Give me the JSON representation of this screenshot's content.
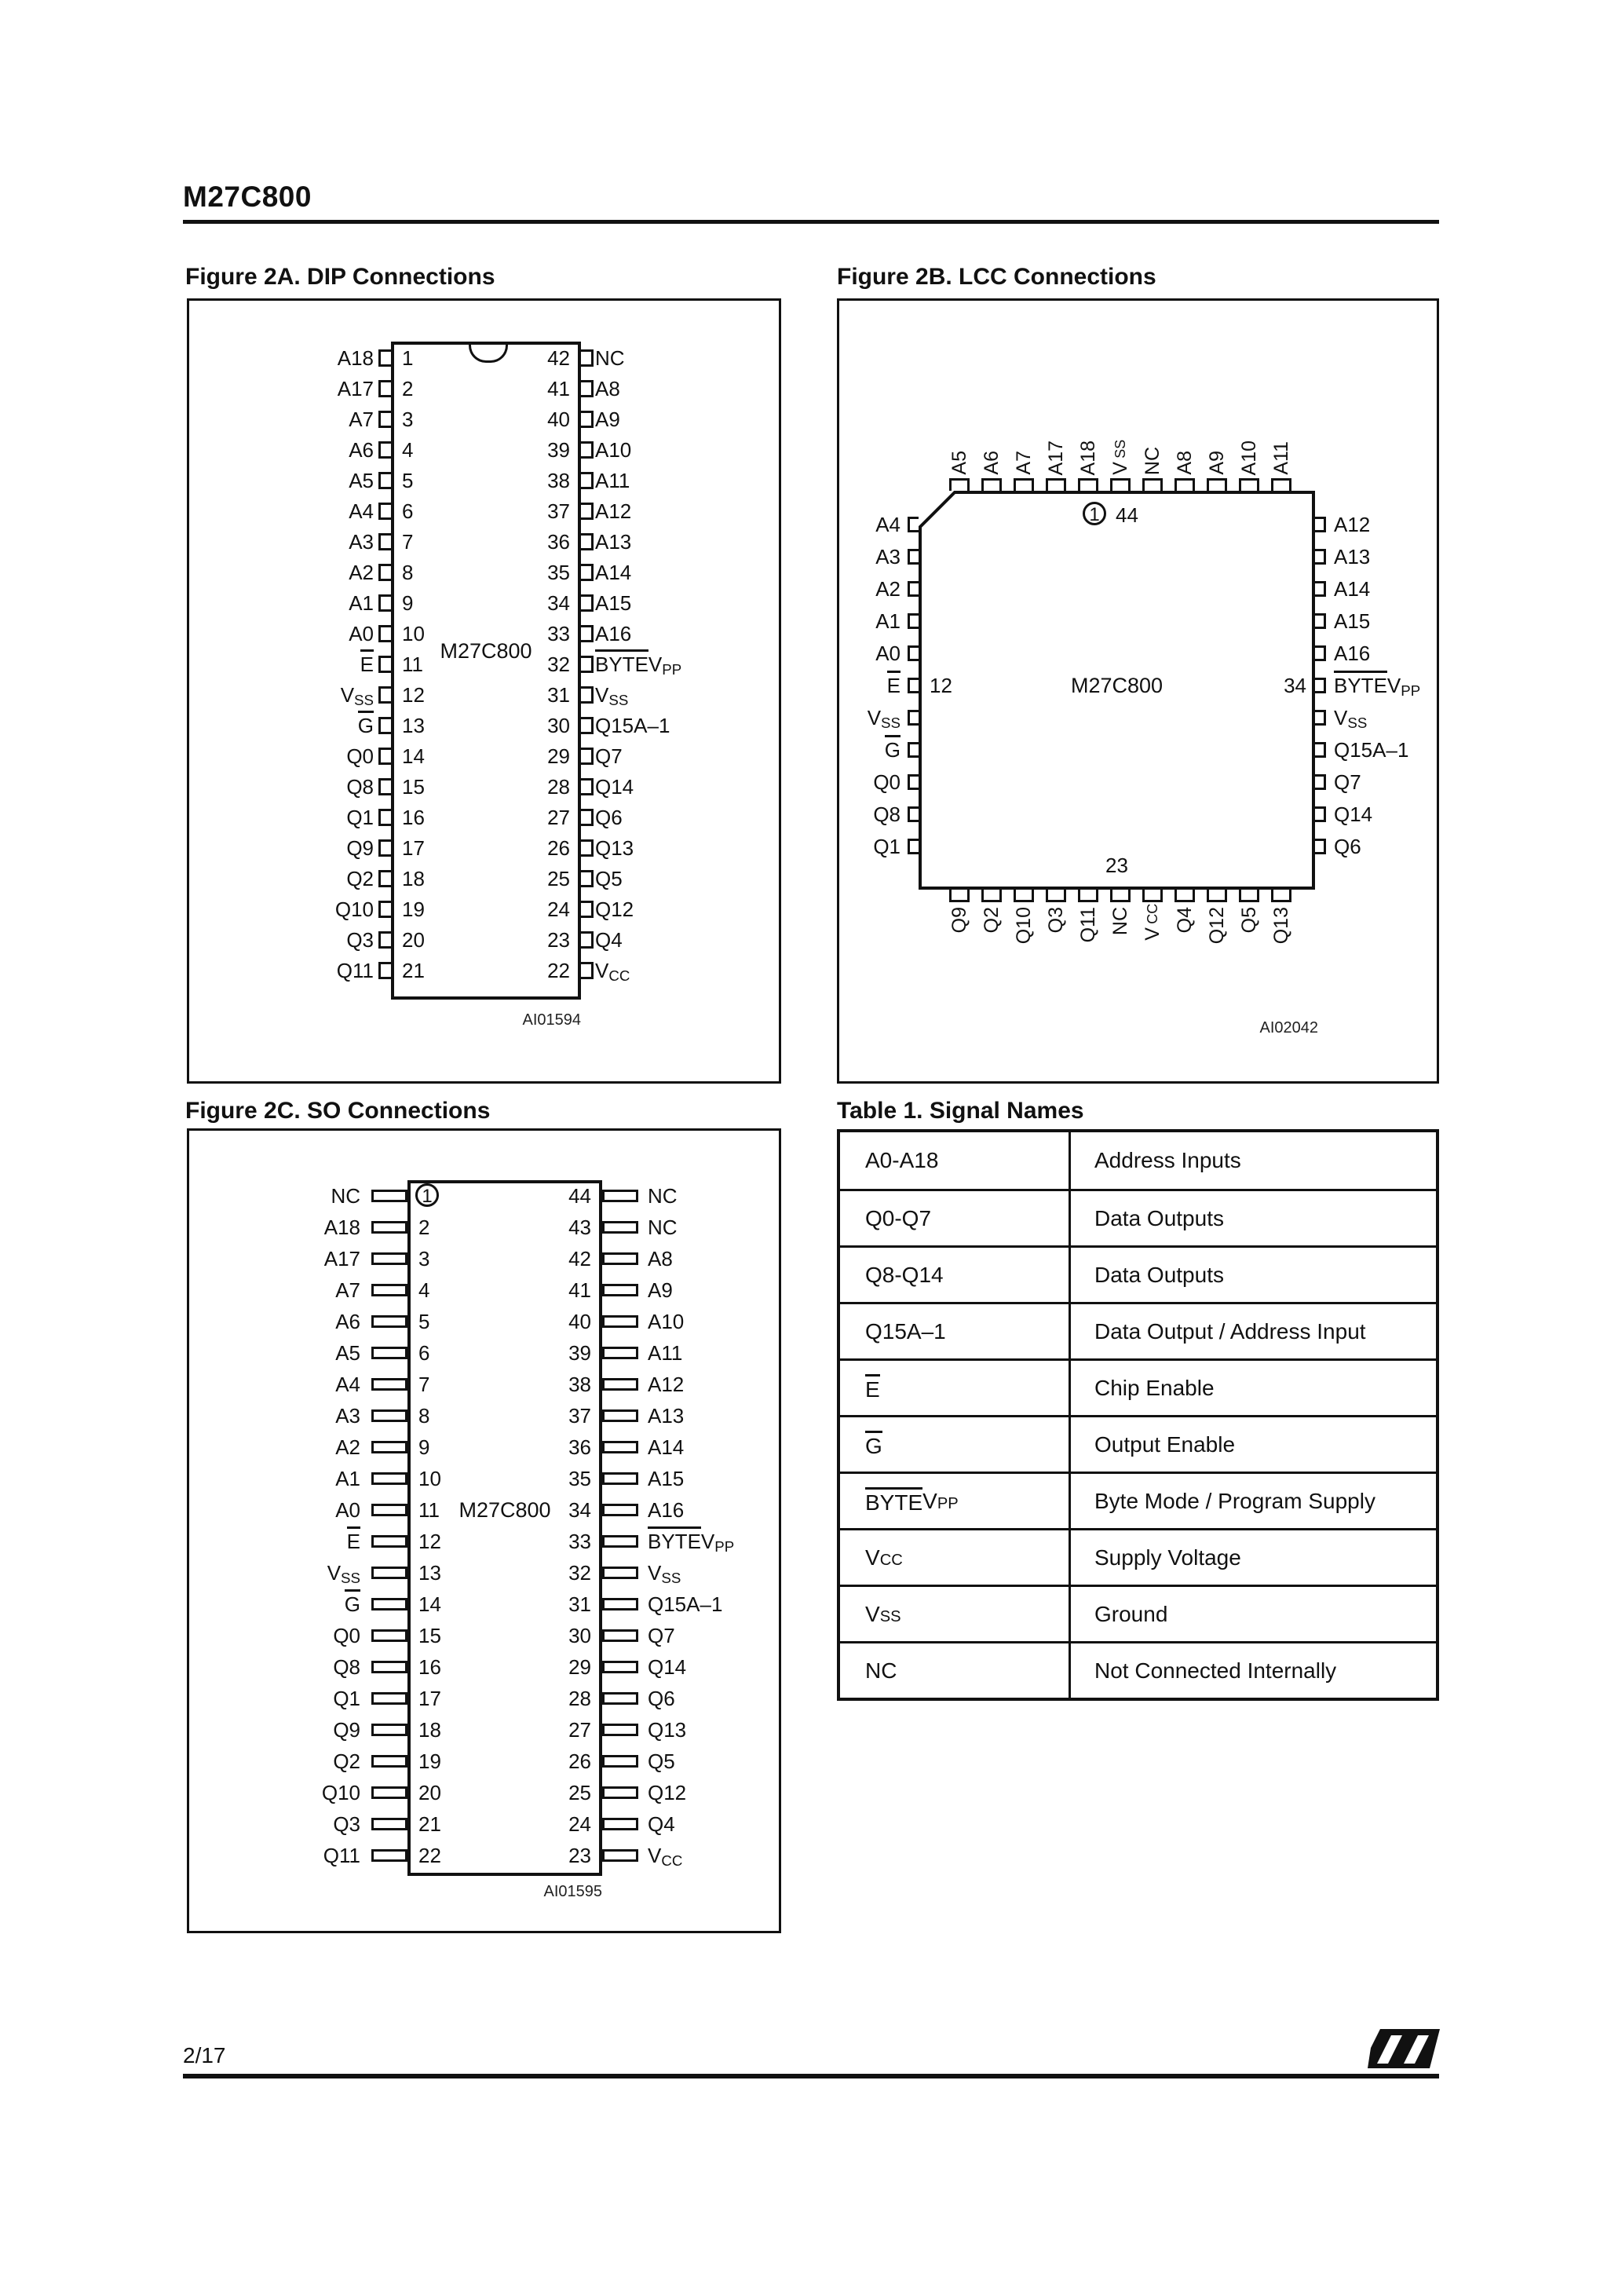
{
  "page": {
    "title": "M27C800",
    "page_number": "2/17",
    "logo_icon": "st-logo"
  },
  "figure_2a": {
    "title": "Figure 2A. DIP Connections",
    "chip_label": "M27C800",
    "tag": "AI01594",
    "left_pins": [
      {
        "label": "A18",
        "num": "1"
      },
      {
        "label": "A17",
        "num": "2"
      },
      {
        "label": "A7",
        "num": "3"
      },
      {
        "label": "A6",
        "num": "4"
      },
      {
        "label": "A5",
        "num": "5"
      },
      {
        "label": "A4",
        "num": "6"
      },
      {
        "label": "A3",
        "num": "7"
      },
      {
        "label": "A2",
        "num": "8"
      },
      {
        "label": "A1",
        "num": "9"
      },
      {
        "label": "A0",
        "num": "10"
      },
      {
        "label": "~E~",
        "num": "11"
      },
      {
        "label": "V_SS_",
        "num": "12"
      },
      {
        "label": "~G~",
        "num": "13"
      },
      {
        "label": "Q0",
        "num": "14"
      },
      {
        "label": "Q8",
        "num": "15"
      },
      {
        "label": "Q1",
        "num": "16"
      },
      {
        "label": "Q9",
        "num": "17"
      },
      {
        "label": "Q2",
        "num": "18"
      },
      {
        "label": "Q10",
        "num": "19"
      },
      {
        "label": "Q3",
        "num": "20"
      },
      {
        "label": "Q11",
        "num": "21"
      }
    ],
    "right_pins": [
      {
        "num": "42",
        "label": "NC"
      },
      {
        "num": "41",
        "label": "A8"
      },
      {
        "num": "40",
        "label": "A9"
      },
      {
        "num": "39",
        "label": "A10"
      },
      {
        "num": "38",
        "label": "A11"
      },
      {
        "num": "37",
        "label": "A12"
      },
      {
        "num": "36",
        "label": "A13"
      },
      {
        "num": "35",
        "label": "A14"
      },
      {
        "num": "34",
        "label": "A15"
      },
      {
        "num": "33",
        "label": "A16"
      },
      {
        "num": "32",
        "label": "~BYTE~V_PP_"
      },
      {
        "num": "31",
        "label": "V_SS_"
      },
      {
        "num": "30",
        "label": "Q15A–1"
      },
      {
        "num": "29",
        "label": "Q7"
      },
      {
        "num": "28",
        "label": "Q14"
      },
      {
        "num": "27",
        "label": "Q6"
      },
      {
        "num": "26",
        "label": "Q13"
      },
      {
        "num": "25",
        "label": "Q5"
      },
      {
        "num": "24",
        "label": "Q12"
      },
      {
        "num": "23",
        "label": "Q4"
      },
      {
        "num": "22",
        "label": "V_CC_"
      }
    ]
  },
  "figure_2b": {
    "title": "Figure 2B. LCC Connections",
    "chip_label": "M27C800",
    "tag": "AI02042",
    "pin1_marker": "1",
    "top_right_num": "44",
    "left_num": "12",
    "right_num": "34",
    "bottom_num": "23",
    "top_pins": [
      "A5",
      "A6",
      "A7",
      "A17",
      "A18",
      "V_SS_",
      "NC",
      "A8",
      "A9",
      "A10",
      "A11"
    ],
    "left_pins": [
      "A4",
      "A3",
      "A2",
      "A1",
      "A0",
      "~E~",
      "V_SS_",
      "~G~",
      "Q0",
      "Q8",
      "Q1"
    ],
    "right_pins": [
      "A12",
      "A13",
      "A14",
      "A15",
      "A16",
      "~BYTE~V_PP_",
      "V_SS_",
      "Q15A–1",
      "Q7",
      "Q14",
      "Q6"
    ],
    "bottom_pins": [
      "Q9",
      "Q2",
      "Q10",
      "Q3",
      "Q11",
      "NC",
      "V_CC_",
      "Q4",
      "Q12",
      "Q5",
      "Q13"
    ]
  },
  "figure_2c": {
    "title": "Figure 2C. SO Connections",
    "chip_label": "M27C800",
    "tag": "AI01595",
    "left_pins": [
      {
        "label": "NC",
        "num": "1",
        "circled": true
      },
      {
        "label": "A18",
        "num": "2"
      },
      {
        "label": "A17",
        "num": "3"
      },
      {
        "label": "A7",
        "num": "4"
      },
      {
        "label": "A6",
        "num": "5"
      },
      {
        "label": "A5",
        "num": "6"
      },
      {
        "label": "A4",
        "num": "7"
      },
      {
        "label": "A3",
        "num": "8"
      },
      {
        "label": "A2",
        "num": "9"
      },
      {
        "label": "A1",
        "num": "10"
      },
      {
        "label": "A0",
        "num": "11"
      },
      {
        "label": "~E~",
        "num": "12"
      },
      {
        "label": "V_SS_",
        "num": "13"
      },
      {
        "label": "~G~",
        "num": "14"
      },
      {
        "label": "Q0",
        "num": "15"
      },
      {
        "label": "Q8",
        "num": "16"
      },
      {
        "label": "Q1",
        "num": "17"
      },
      {
        "label": "Q9",
        "num": "18"
      },
      {
        "label": "Q2",
        "num": "19"
      },
      {
        "label": "Q10",
        "num": "20"
      },
      {
        "label": "Q3",
        "num": "21"
      },
      {
        "label": "Q11",
        "num": "22"
      }
    ],
    "right_pins": [
      {
        "num": "44",
        "label": "NC"
      },
      {
        "num": "43",
        "label": "NC"
      },
      {
        "num": "42",
        "label": "A8"
      },
      {
        "num": "41",
        "label": "A9"
      },
      {
        "num": "40",
        "label": "A10"
      },
      {
        "num": "39",
        "label": "A11"
      },
      {
        "num": "38",
        "label": "A12"
      },
      {
        "num": "37",
        "label": "A13"
      },
      {
        "num": "36",
        "label": "A14"
      },
      {
        "num": "35",
        "label": "A15"
      },
      {
        "num": "34",
        "label": "A16"
      },
      {
        "num": "33",
        "label": "~BYTE~V_PP_"
      },
      {
        "num": "32",
        "label": "V_SS_"
      },
      {
        "num": "31",
        "label": "Q15A–1"
      },
      {
        "num": "30",
        "label": "Q7"
      },
      {
        "num": "29",
        "label": "Q14"
      },
      {
        "num": "28",
        "label": "Q6"
      },
      {
        "num": "27",
        "label": "Q13"
      },
      {
        "num": "26",
        "label": "Q5"
      },
      {
        "num": "25",
        "label": "Q12"
      },
      {
        "num": "24",
        "label": "Q4"
      },
      {
        "num": "23",
        "label": "V_CC_"
      }
    ]
  },
  "table_1": {
    "title": "Table 1. Signal Names",
    "rows": [
      {
        "signal": "A0-A18",
        "description": "Address Inputs"
      },
      {
        "signal": "Q0-Q7",
        "description": "Data Outputs"
      },
      {
        "signal": "Q8-Q14",
        "description": "Data Outputs"
      },
      {
        "signal": "Q15A–1",
        "description": "Data Output / Address Input"
      },
      {
        "signal": "~E~",
        "description": "Chip Enable"
      },
      {
        "signal": "~G~",
        "description": "Output Enable"
      },
      {
        "signal": "~BYTE~V_PP_",
        "description": "Byte Mode / Program Supply"
      },
      {
        "signal": "V_CC_",
        "description": "Supply Voltage"
      },
      {
        "signal": "V_SS_",
        "description": "Ground"
      },
      {
        "signal": "NC",
        "description": "Not Connected Internally"
      }
    ]
  }
}
